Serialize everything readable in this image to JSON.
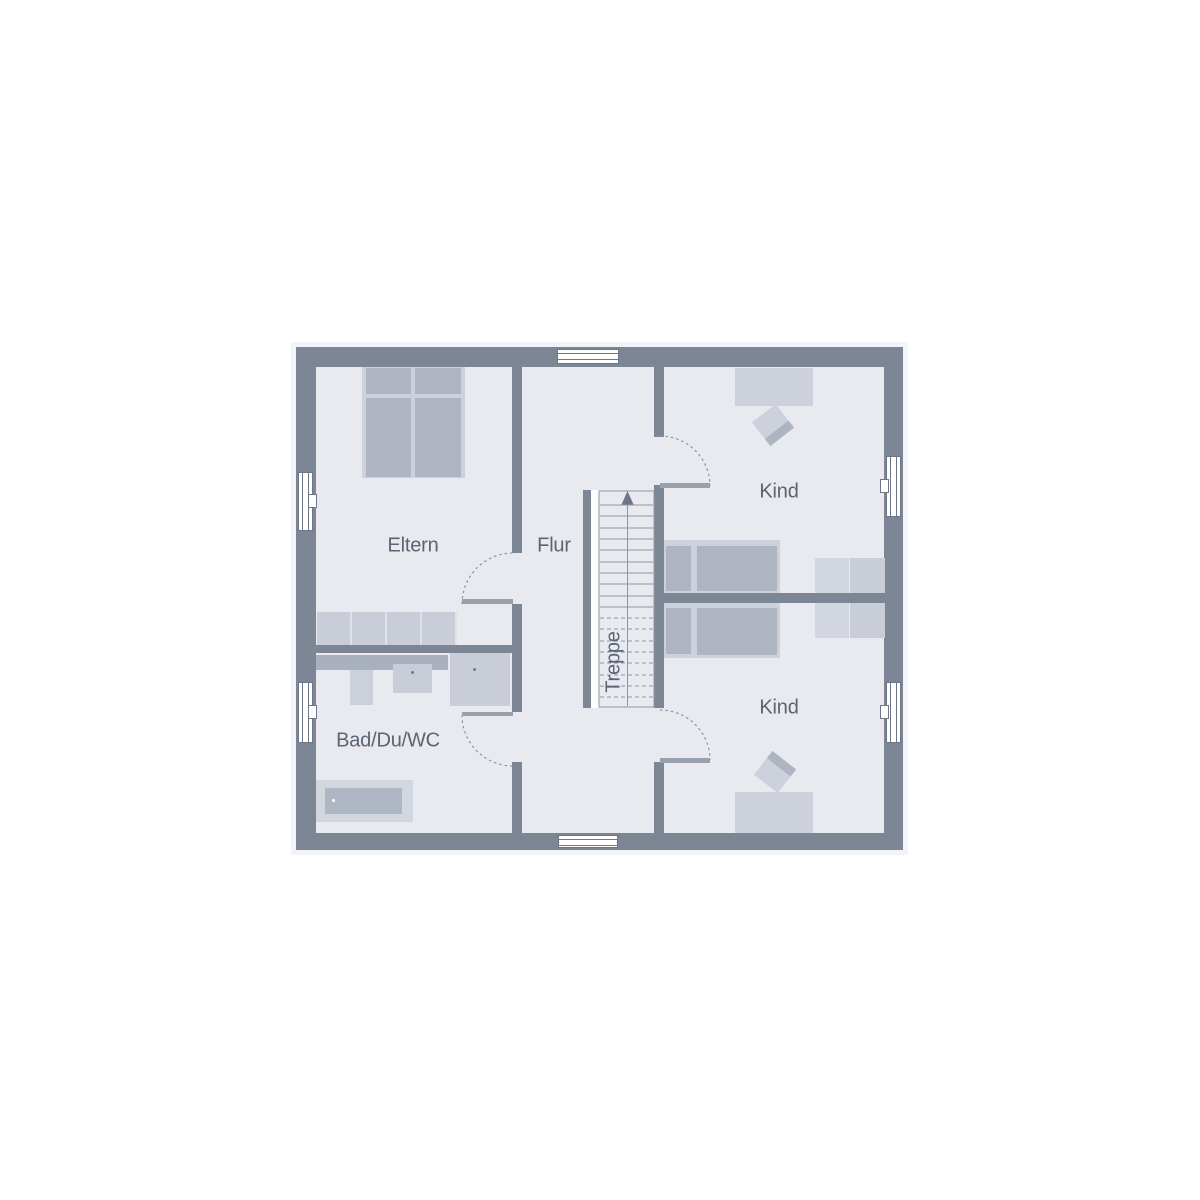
{
  "plan": {
    "kind": "residential upper-floor plan",
    "window_count": 6,
    "door_count": 4
  },
  "rooms": {
    "eltern": {
      "label": "Eltern",
      "furniture": [
        "double-bed",
        "wardrobe-row"
      ]
    },
    "flur": {
      "label": "Flur",
      "furniture": []
    },
    "kind_top": {
      "label": "Kind",
      "furniture": [
        "desk",
        "chair",
        "bed",
        "wardrobe"
      ]
    },
    "kind_bottom": {
      "label": "Kind",
      "furniture": [
        "bed",
        "wardrobe",
        "chair",
        "desk"
      ]
    },
    "bad": {
      "label": "Bad/Du/WC",
      "furniture": [
        "vanity-counter",
        "wc",
        "washbasin",
        "shower",
        "bathtub"
      ]
    },
    "stairs": {
      "label": "Treppe",
      "direction": "up",
      "solid_treads": 10,
      "dashed_treads": 8
    }
  },
  "colors": {
    "wall": "#7D8695",
    "floor": "#E8EAEF",
    "furniture_light": "#CCD1DB",
    "furniture_medium": "#AEB4C2",
    "counter": "#A9B0BE",
    "fixture": "#CBD0DA",
    "wardrobe_light": "#D2D6DF",
    "wardrobe_dark": "#C8CDD7",
    "tub_inner": "#B0B7C4",
    "divider": "#DFE2E9",
    "line": "#8E96A5",
    "door_leaf": "#99A1AF",
    "window_frame": "#6E7787",
    "arrow": "#6E7787",
    "text": "#5A6472",
    "shadow": "#F2F4F8"
  }
}
